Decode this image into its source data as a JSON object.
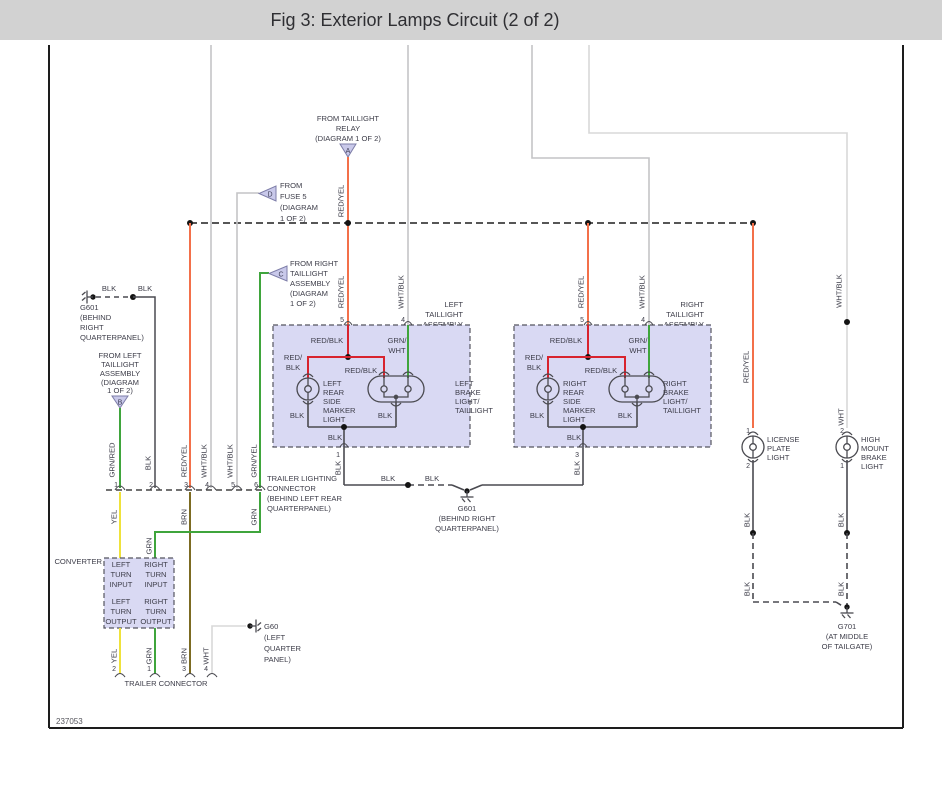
{
  "title": "Fig 3: Exterior Lamps Circuit (2 of 2)",
  "figure_id": "237053",
  "colors": {
    "titlebar_bg": "#d2d2d2",
    "red_yel": "#f3704a",
    "red_blk": "#d8232e",
    "green": "#3fa53c",
    "yellow": "#efe23b",
    "brown": "#7c6b22",
    "white_wire": "#d8d8d8",
    "wht_blk_wire": "#c4c4c6",
    "blk_wire": "#4a4a50",
    "box_fill": "#d9d9f3"
  },
  "ref": {
    "a": {
      "letter": "A",
      "lines": [
        "FROM TAILLIGHT",
        "RELAY",
        "(DIAGRAM 1 OF 2)"
      ]
    },
    "b": {
      "letter": "B",
      "lines": [
        "FROM LEFT",
        "TAILLIGHT",
        "ASSEMBLY",
        "(DIAGRAM",
        "1 OF 2)"
      ]
    },
    "c": {
      "letter": "C",
      "lines": [
        "FROM RIGHT",
        "TAILLIGHT",
        "ASSEMBLY",
        "(DIAGRAM",
        "1 OF 2)"
      ]
    },
    "d": {
      "letter": "D",
      "lines": [
        "FROM",
        "FUSE 5",
        "(DIAGRAM",
        "1 OF 2)"
      ]
    }
  },
  "g601_top": {
    "lines": [
      "G601",
      "(BEHIND",
      "RIGHT",
      "QUARTERPANEL)"
    ],
    "wire1": "BLK",
    "wire2": "BLK"
  },
  "g601_mid": {
    "lines": [
      "G601",
      "(BEHIND RIGHT",
      "QUARTERPANEL)"
    ]
  },
  "g60": {
    "lines": [
      "G60",
      "(LEFT",
      "QUARTER",
      "PANEL)"
    ]
  },
  "g701": {
    "lines": [
      "G701",
      "(AT MIDDLE",
      "OF TAILGATE)"
    ]
  },
  "ground_run": {
    "out_left": "BLK",
    "seg1": "BLK",
    "seg2": "BLK",
    "out_right": "BLK"
  },
  "left_asm": {
    "name": [
      "LEFT",
      "TAILLIGHT",
      "ASSEMBLY"
    ],
    "pins": {
      "in1": "5",
      "in2": "4",
      "out": "1"
    },
    "feed1": "RED/YEL",
    "feed2": "WHT/BLK",
    "inner": {
      "top": "RED/BLK",
      "grn1": "GRN/",
      "grn2": "WHT",
      "left1": "RED/",
      "left2": "BLK",
      "mid": "RED/BLK",
      "blk_l": "BLK",
      "blk_r": "BLK",
      "out": "BLK"
    },
    "marker": [
      "LEFT",
      "REAR",
      "SIDE",
      "MARKER",
      "LIGHT"
    ],
    "brake": [
      "LEFT",
      "BRAKE",
      "LIGHT/",
      "TAILLIGHT"
    ]
  },
  "right_asm": {
    "name": [
      "RIGHT",
      "TAILLIGHT",
      "ASSEMBLY"
    ],
    "pins": {
      "in1": "5",
      "in2": "4",
      "out": "3"
    },
    "feed1": "RED/YEL",
    "feed2": "WHT/BLK",
    "inner": {
      "top": "RED/BLK",
      "grn1": "GRN/",
      "grn2": "WHT",
      "left1": "RED/",
      "left2": "BLK",
      "mid": "RED/BLK",
      "blk_l": "BLK",
      "blk_r": "BLK",
      "out": "BLK"
    },
    "marker": [
      "RIGHT",
      "REAR",
      "SIDE",
      "MARKER",
      "LIGHT"
    ],
    "brake": [
      "RIGHT",
      "BRAKE",
      "LIGHT/",
      "TAILLIGHT"
    ]
  },
  "license": {
    "name": [
      "LICENSE",
      "PLATE",
      "LIGHT"
    ],
    "feed": "RED/YEL",
    "pin_top": "1",
    "pin_bottom": "2",
    "blk1": "BLK",
    "blk2": "BLK"
  },
  "highmount": {
    "name": [
      "HIGH",
      "MOUNT",
      "BRAKE",
      "LIGHT"
    ],
    "feed_top": "WHT/BLK",
    "feed_bottom": "WHT",
    "pin_top": "2",
    "pin_bottom": "1",
    "blk1": "BLK",
    "blk2": "BLK"
  },
  "trailer_top": {
    "label": [
      "TRAILER LIGHTING",
      "CONNECTOR",
      "(BEHIND LEFT REAR",
      "QUARTERPANEL)"
    ],
    "pins": [
      "1",
      "2",
      "3",
      "4",
      "5",
      "6"
    ],
    "wires": [
      "GRN/RED",
      "BLK",
      "RED/YEL",
      "WHT/BLK",
      "WHT/BLK",
      "GRN/YEL"
    ],
    "below": [
      "YEL",
      "BRN",
      "GRN",
      "GRN"
    ]
  },
  "converter": {
    "name": "CONVERTER",
    "cells": [
      "LEFT",
      "TURN",
      "INPUT",
      "RIGHT",
      "TURN",
      "INPUT",
      "LEFT",
      "TURN",
      "OUTPUT",
      "RIGHT",
      "TURN",
      "OUTPUT"
    ]
  },
  "trailer_bottom": {
    "label": "TRAILER CONNECTOR",
    "pins": [
      "2",
      "1",
      "3",
      "4"
    ],
    "wires": [
      "YEL",
      "GRN",
      "BRN",
      "WHT"
    ]
  }
}
